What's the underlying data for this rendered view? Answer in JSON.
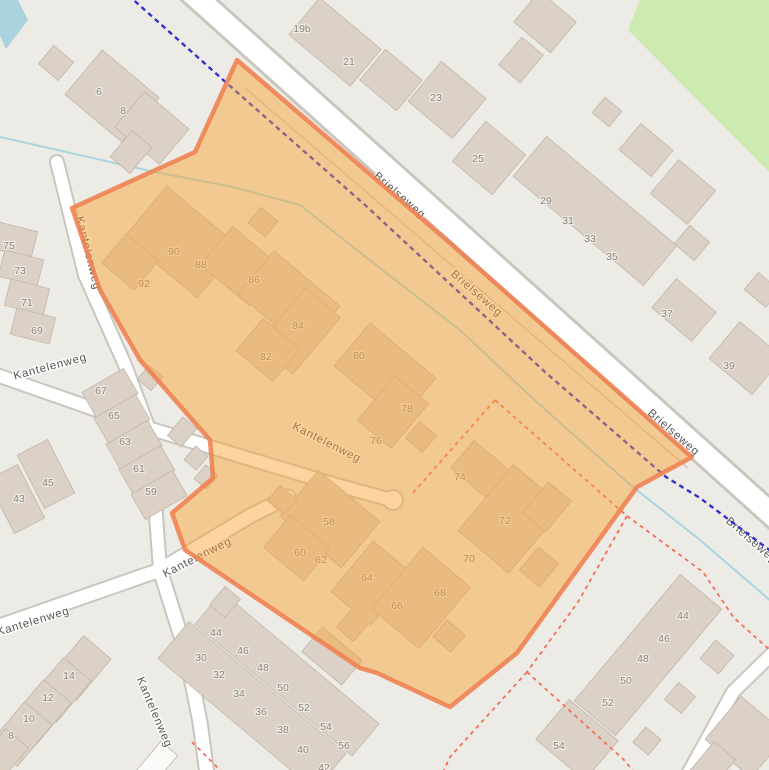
{
  "map": {
    "street_labels": [
      {
        "text": "Brielseweg",
        "x": 400,
        "y": 195,
        "rot": 41
      },
      {
        "text": "Brielseweg",
        "x": 477,
        "y": 293,
        "rot": 41
      },
      {
        "text": "Brielseweg",
        "x": 674,
        "y": 432,
        "rot": 41
      },
      {
        "text": "Brielseweg",
        "x": 752,
        "y": 540,
        "rot": 41
      },
      {
        "text": "Kantelenweg",
        "x": 89,
        "y": 253,
        "rot": 76
      },
      {
        "text": "Kantelenweg",
        "x": 50,
        "y": 366,
        "rot": -15
      },
      {
        "text": "Kantelenweg",
        "x": 327,
        "y": 442,
        "rot": 27
      },
      {
        "text": "Kantelenweg",
        "x": 33,
        "y": 621,
        "rot": -17
      },
      {
        "text": "Kantelenweg",
        "x": 197,
        "y": 557,
        "rot": -27
      },
      {
        "text": "Kantelenweg",
        "x": 155,
        "y": 712,
        "rot": 67
      }
    ],
    "house_numbers": [
      {
        "text": "6",
        "x": 99,
        "y": 91
      },
      {
        "text": "8",
        "x": 123,
        "y": 110
      },
      {
        "text": "19b",
        "x": 302,
        "y": 28
      },
      {
        "text": "21",
        "x": 349,
        "y": 61
      },
      {
        "text": "23",
        "x": 436,
        "y": 97
      },
      {
        "text": "25",
        "x": 478,
        "y": 158
      },
      {
        "text": "29",
        "x": 546,
        "y": 200
      },
      {
        "text": "31",
        "x": 568,
        "y": 220
      },
      {
        "text": "33",
        "x": 590,
        "y": 238
      },
      {
        "text": "35",
        "x": 612,
        "y": 256
      },
      {
        "text": "37",
        "x": 667,
        "y": 313
      },
      {
        "text": "39",
        "x": 729,
        "y": 365
      },
      {
        "text": "75",
        "x": 9,
        "y": 245
      },
      {
        "text": "73",
        "x": 20,
        "y": 270
      },
      {
        "text": "71",
        "x": 27,
        "y": 302
      },
      {
        "text": "69",
        "x": 37,
        "y": 330
      },
      {
        "text": "67",
        "x": 101,
        "y": 390
      },
      {
        "text": "65",
        "x": 114,
        "y": 415
      },
      {
        "text": "63",
        "x": 125,
        "y": 441
      },
      {
        "text": "61",
        "x": 139,
        "y": 468
      },
      {
        "text": "59",
        "x": 151,
        "y": 491
      },
      {
        "text": "45",
        "x": 48,
        "y": 482
      },
      {
        "text": "43",
        "x": 19,
        "y": 498
      },
      {
        "text": "90",
        "x": 174,
        "y": 251
      },
      {
        "text": "88",
        "x": 201,
        "y": 264
      },
      {
        "text": "92",
        "x": 144,
        "y": 283
      },
      {
        "text": "86",
        "x": 254,
        "y": 279
      },
      {
        "text": "84",
        "x": 298,
        "y": 325
      },
      {
        "text": "82",
        "x": 266,
        "y": 356
      },
      {
        "text": "80",
        "x": 359,
        "y": 355
      },
      {
        "text": "78",
        "x": 407,
        "y": 408
      },
      {
        "text": "76",
        "x": 376,
        "y": 440
      },
      {
        "text": "74",
        "x": 460,
        "y": 476
      },
      {
        "text": "72",
        "x": 505,
        "y": 520
      },
      {
        "text": "70",
        "x": 469,
        "y": 558
      },
      {
        "text": "58",
        "x": 329,
        "y": 521
      },
      {
        "text": "60",
        "x": 300,
        "y": 552
      },
      {
        "text": "62",
        "x": 321,
        "y": 559
      },
      {
        "text": "64",
        "x": 367,
        "y": 577
      },
      {
        "text": "66",
        "x": 397,
        "y": 605
      },
      {
        "text": "68",
        "x": 440,
        "y": 592
      },
      {
        "text": "14",
        "x": 69,
        "y": 675
      },
      {
        "text": "12",
        "x": 48,
        "y": 697
      },
      {
        "text": "10",
        "x": 29,
        "y": 718
      },
      {
        "text": "8",
        "x": 11,
        "y": 735
      },
      {
        "text": "30",
        "x": 201,
        "y": 657
      },
      {
        "text": "32",
        "x": 219,
        "y": 674
      },
      {
        "text": "34",
        "x": 239,
        "y": 693
      },
      {
        "text": "36",
        "x": 261,
        "y": 711
      },
      {
        "text": "38",
        "x": 283,
        "y": 729
      },
      {
        "text": "40",
        "x": 303,
        "y": 749
      },
      {
        "text": "42",
        "x": 324,
        "y": 767
      },
      {
        "text": "44",
        "x": 216,
        "y": 632
      },
      {
        "text": "46",
        "x": 243,
        "y": 650
      },
      {
        "text": "48",
        "x": 263,
        "y": 667
      },
      {
        "text": "50",
        "x": 283,
        "y": 687
      },
      {
        "text": "52",
        "x": 304,
        "y": 707
      },
      {
        "text": "54",
        "x": 326,
        "y": 726
      },
      {
        "text": "56",
        "x": 344,
        "y": 745
      },
      {
        "text": "44",
        "x": 683,
        "y": 615
      },
      {
        "text": "46",
        "x": 664,
        "y": 638
      },
      {
        "text": "48",
        "x": 643,
        "y": 658
      },
      {
        "text": "50",
        "x": 626,
        "y": 680
      },
      {
        "text": "52",
        "x": 608,
        "y": 702
      },
      {
        "text": "54",
        "x": 559,
        "y": 745
      }
    ],
    "colors": {
      "land": "#edebe5",
      "water": "#aad3df",
      "grass": "#cdebb0",
      "road_fill": "#ffffff",
      "road_casing": "#c9c6c0",
      "building_fill": "#dcd1c7",
      "building_stroke": "#c2b5a9",
      "selection_fill": "rgba(250,160,44,0.45)",
      "selection_border": "rgba(238,126,78,0.85)",
      "route_blue": "#3333cc",
      "boundary_red": "#f2705a",
      "stream": "#a6d5e0",
      "street_label": "#4d4d4d",
      "house_number": "#8b8177"
    }
  }
}
